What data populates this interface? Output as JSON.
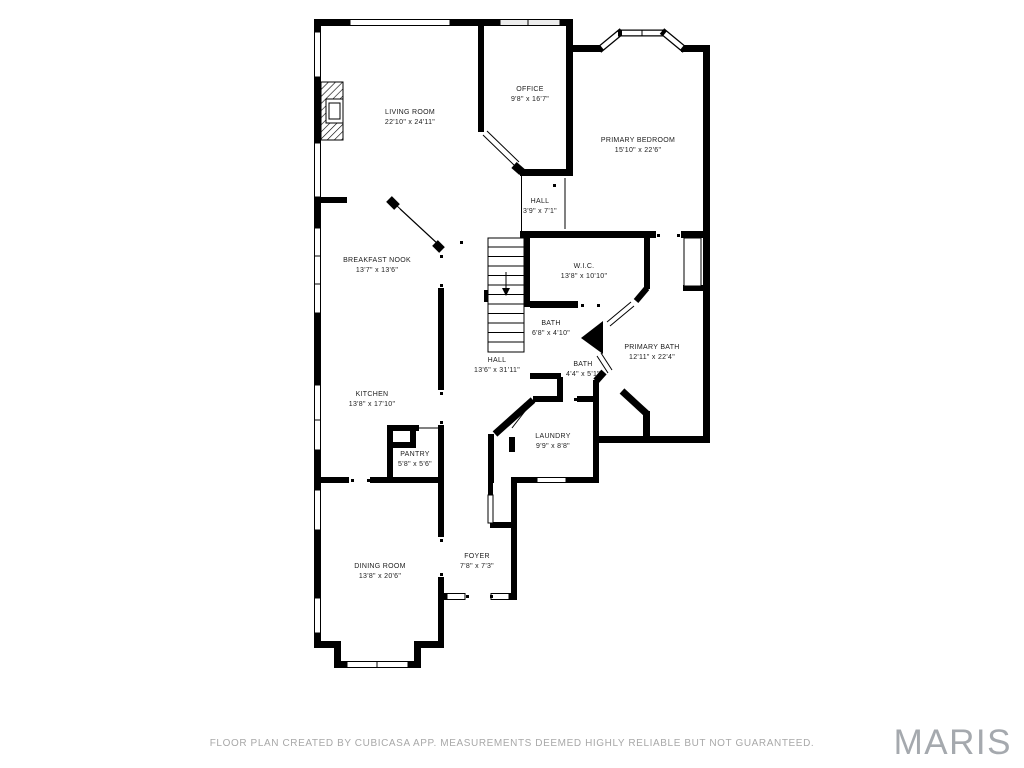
{
  "rooms": [
    {
      "name": "LIVING ROOM",
      "dims": "22'10\" x 24'11\""
    },
    {
      "name": "OFFICE",
      "dims": "9'8\" x 16'7\""
    },
    {
      "name": "PRIMARY BEDROOM",
      "dims": "15'10\" x 22'6\""
    },
    {
      "name": "HALL",
      "dims": "3'9\" x 7'1\""
    },
    {
      "name": "BREAKFAST NOOK",
      "dims": "13'7\" x 13'6\""
    },
    {
      "name": "W.I.C.",
      "dims": "13'8\" x 10'10\""
    },
    {
      "name": "BATH",
      "dims": "6'8\" x 4'10\""
    },
    {
      "name": "HALL",
      "dims": "13'6\" x 31'11\""
    },
    {
      "name": "PRIMARY BATH",
      "dims": "12'11\" x 22'4\""
    },
    {
      "name": "BATH",
      "dims": "4'4\" x 5'1\""
    },
    {
      "name": "KITCHEN",
      "dims": "13'8\" x 17'10\""
    },
    {
      "name": "LAUNDRY",
      "dims": "9'9\" x 8'8\""
    },
    {
      "name": "PANTRY",
      "dims": "5'8\" x 5'6\""
    },
    {
      "name": "DINING ROOM",
      "dims": "13'8\" x 20'6\""
    },
    {
      "name": "FOYER",
      "dims": "7'8\" x 7'3\""
    }
  ],
  "footer": "FLOOR PLAN CREATED BY CUBICASA APP. MEASUREMENTS DEEMED HIGHLY RELIABLE BUT NOT GUARANTEED.",
  "logo": "MARIS",
  "colors": {
    "wall": "#000000",
    "room_label": "#1c1c1c",
    "footer_text": "#a8a8a8",
    "logo_text": "#a5a9ae",
    "background": "#ffffff"
  }
}
